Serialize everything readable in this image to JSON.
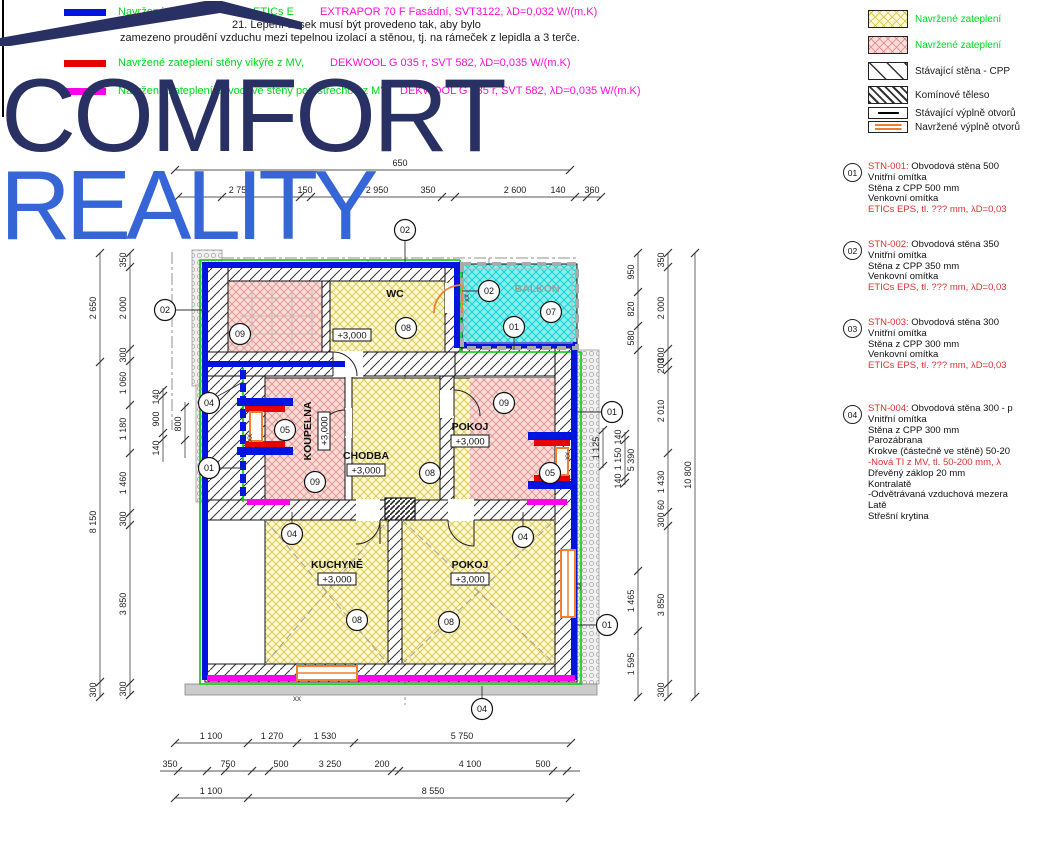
{
  "logo": {
    "line1": "COMFORT",
    "line2": "REALITY"
  },
  "legend_top": {
    "row1_green1": "Navržené zat",
    "row1_green2": "ETICs E",
    "row1_magenta": "EXTRAPOR 70 F Fasádní, SVT3122,  λD=0,032 W/(m.K)",
    "note1": "21. Lepení desek musí být provedeno tak, aby bylo",
    "note2": "zamezeno proudění vzduchu mezi tepelnou izolací a stěnou, tj. na rámeček z lepidla a 3 terče.",
    "row2_green": "Navržené zateplení stěny vikýře z MV,",
    "row2_magenta": "DEKWOOL G 035 r, SVT 582,  λD=0,035 W/(m.K)",
    "row3_green": "Navržené zateplení obvodové stěny pod střechou z MV,",
    "row3_magenta": "DEKWOOL G 035 r, SVT 582,  λD=0,035 W/(m.K)"
  },
  "legend_right": {
    "items": [
      {
        "swatch": "yellow-crosshatch",
        "label": "Navržené zateplení"
      },
      {
        "swatch": "red-crosshatch",
        "label": "Navržené zateplení"
      },
      {
        "swatch": "existing-wall-hatch",
        "label": "Stávající stěna - CPP"
      },
      {
        "swatch": "chimney-hatch",
        "label": "Komínové těleso"
      },
      {
        "swatch": "existing-opening",
        "label": "Stávající výplně otvorů"
      },
      {
        "swatch": "new-opening",
        "label": "Navržené výplně otvorů"
      }
    ]
  },
  "wall_types": [
    {
      "ref": "01",
      "code": "STN-001:",
      "title": "Obvodová stěna 500",
      "lines": [
        [
          "Vnitřní omítka",
          0
        ],
        [
          "Stěna z CPP 500 mm",
          0
        ],
        [
          "Venkovní omítka",
          0
        ],
        [
          "ETICs EPS, tl. ??? mm,  λD=0,03",
          1
        ]
      ]
    },
    {
      "ref": "02",
      "code": "STN-002:",
      "title": "Obvodová stěna 350",
      "lines": [
        [
          "Vnitřní omítka",
          0
        ],
        [
          "Stěna z CPP 350 mm",
          0
        ],
        [
          "Venkovní omítka",
          0
        ],
        [
          "ETICs EPS, tl. ??? mm,  λD=0,03",
          1
        ]
      ]
    },
    {
      "ref": "03",
      "code": "STN-003:",
      "title": "Obvodová stěna 300",
      "lines": [
        [
          "Vnitřní omítka",
          0
        ],
        [
          "Stěna z CPP 300 mm",
          0
        ],
        [
          "Venkovní omítka",
          0
        ],
        [
          "ETICs EPS, tl. ??? mm,  λD=0,03",
          1
        ]
      ]
    },
    {
      "ref": "04",
      "code": "STN-004:",
      "title": "Obvodová stěna 300 - p",
      "lines": [
        [
          "Vnitřní omítka",
          0
        ],
        [
          "Stěna z CPP 300 mm",
          0
        ],
        [
          "Parozábrana",
          0
        ],
        [
          "Krokve (částečně ve stěně) 50-20",
          0
        ],
        [
          "-Nová TI z MV, tl. 50-200 mm,  λ",
          1
        ],
        [
          "Dřevěný záklop 20 mm",
          0
        ],
        [
          "Kontralatě",
          0
        ],
        [
          "-Odvětrávaná vzduchová mezera",
          0
        ],
        [
          "Latě",
          0
        ],
        [
          "Střešní krytina",
          0
        ]
      ]
    }
  ],
  "rooms": {
    "wc": "WC",
    "balkon": "BALKÓN",
    "koupelna": "KOUPELNA",
    "chodba": "CHODBA",
    "pokoj1": "POKOJ",
    "kuchyne": "KUCHYNĚ",
    "pokoj2": "POKOJ",
    "level": "+3,000",
    "xx": "xx"
  },
  "markers": [
    {
      "n": "02",
      "x": 405,
      "y": 230
    },
    {
      "n": "02",
      "x": 165,
      "y": 310
    },
    {
      "n": "02",
      "x": 489,
      "y": 291
    },
    {
      "n": "07",
      "x": 551,
      "y": 312
    },
    {
      "n": "01",
      "x": 514,
      "y": 327
    },
    {
      "n": "09",
      "x": 240,
      "y": 334
    },
    {
      "n": "08",
      "x": 406,
      "y": 328
    },
    {
      "n": "04",
      "x": 209,
      "y": 403
    },
    {
      "n": "01",
      "x": 209,
      "y": 468
    },
    {
      "n": "05",
      "x": 285,
      "y": 430
    },
    {
      "n": "09",
      "x": 315,
      "y": 482
    },
    {
      "n": "08",
      "x": 430,
      "y": 473
    },
    {
      "n": "09",
      "x": 504,
      "y": 403
    },
    {
      "n": "01",
      "x": 612,
      "y": 412
    },
    {
      "n": "05",
      "x": 550,
      "y": 473
    },
    {
      "n": "04",
      "x": 292,
      "y": 534
    },
    {
      "n": "04",
      "x": 523,
      "y": 537
    },
    {
      "n": "08",
      "x": 357,
      "y": 620
    },
    {
      "n": "08",
      "x": 449,
      "y": 622
    },
    {
      "n": "01",
      "x": 607,
      "y": 625
    },
    {
      "n": "04",
      "x": 482,
      "y": 709
    }
  ],
  "dims": {
    "t1": [
      "650"
    ],
    "t2": [
      "2 750",
      "150",
      "2 950",
      "350",
      "2 600",
      "140",
      "360"
    ],
    "b1": [
      "1 100",
      "1 270",
      "1 530",
      "5 750"
    ],
    "b2": [
      "350",
      "750",
      "500",
      "3 250",
      "200",
      "4 100",
      "500"
    ],
    "b3": [
      "1 100",
      "8 550"
    ],
    "lo": [
      "2 650",
      "8 150",
      "300"
    ],
    "li": [
      "350",
      "2 000",
      "300",
      "1 060",
      "1 180",
      "1 460",
      "300",
      "3 850",
      "300"
    ],
    "ls": [
      "140",
      "900",
      "140",
      "800"
    ],
    "ra": [
      "950",
      "820",
      "580",
      "5 390",
      "1 465",
      "1 595"
    ],
    "rb": [
      "350",
      "2 000",
      "300",
      "200",
      "2 010",
      "1 430",
      "60",
      "300",
      "3 850",
      "300"
    ],
    "ro": [
      "10 800"
    ],
    "rs": [
      "140",
      "1 150",
      "140",
      "1 125"
    ]
  },
  "colors": {
    "insulation_blue": "#0014e0",
    "insulation_red": "#e80000",
    "insulation_magenta": "#ff00e8",
    "outline_green": "#00cc00",
    "new_opening_orange": "#f08030",
    "logo_navy": "#283064",
    "logo_blue": "#3565d6"
  }
}
